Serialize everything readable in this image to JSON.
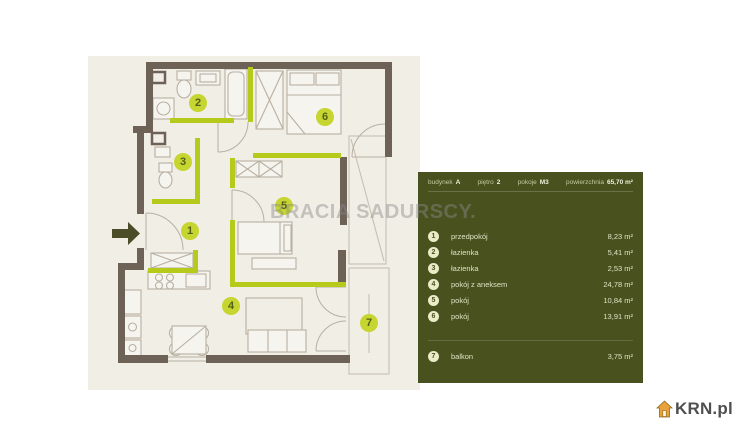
{
  "panel": {
    "header": {
      "building_label": "budynek",
      "building_value": "A",
      "floor_label": "piętro",
      "floor_value": "2",
      "rooms_label": "pokoje",
      "rooms_value": "M3",
      "area_label": "powierzchnia",
      "area_value": "65,70 m²"
    },
    "colors": {
      "background": "#49521f",
      "badge": "#ecebc7",
      "text": "#dde1c0"
    }
  },
  "rooms": [
    {
      "number": "1",
      "name": "przedpokój",
      "area": "8,23 m²"
    },
    {
      "number": "2",
      "name": "łazienka",
      "area": "5,41 m²"
    },
    {
      "number": "3",
      "name": "łazienka",
      "area": "2,53 m²"
    },
    {
      "number": "4",
      "name": "pokój z aneksem",
      "area": "24,78 m²"
    },
    {
      "number": "5",
      "name": "pokój",
      "area": "10,84 m²"
    },
    {
      "number": "6",
      "name": "pokój",
      "area": "13,91 m²"
    },
    {
      "number": "7",
      "name": "balkon",
      "area": "3,75 m²"
    }
  ],
  "watermark": {
    "text": "BRACIA SADURSCY."
  },
  "logo": {
    "text": "KRN.pl"
  },
  "floorplan": {
    "colors": {
      "wall": "#6e6156",
      "accent_wall": "#b5ca1b",
      "background": "#f1eee6",
      "badge": "#c6d52f",
      "furniture_line": "#b8b0a2",
      "entrance_arrow": "#4b4c28"
    }
  }
}
